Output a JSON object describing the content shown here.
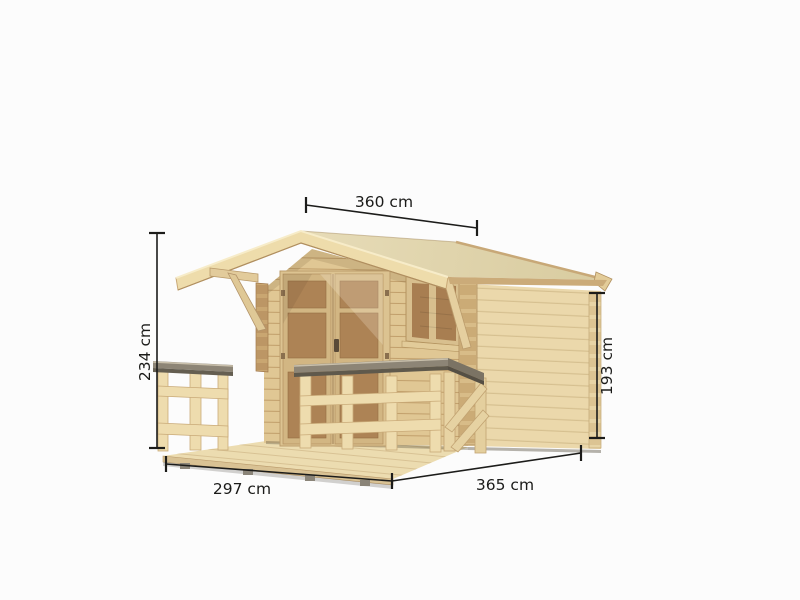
{
  "scene": {
    "subject": "Wooden garden log cabin with gable roof, front porch, terrace and wooden railing",
    "style": "Product dimension diagram on white background",
    "background_color": "#fcfcfc"
  },
  "dimensions": {
    "roof_width": {
      "label": "360 cm",
      "value_cm": 360,
      "placement": "top, along roof ridge"
    },
    "total_height": {
      "label": "234 cm",
      "value_cm": 234,
      "placement": "left, ground to ridge"
    },
    "wall_height": {
      "label": "193 cm",
      "value_cm": 193,
      "placement": "right, ground to eave"
    },
    "terrace_depth": {
      "label": "297 cm",
      "value_cm": 297,
      "placement": "bottom left, terrace front edge"
    },
    "building_width": {
      "label": "365 cm",
      "value_cm": 365,
      "placement": "bottom right, side wall"
    }
  },
  "colors": {
    "dimension_line": "#1c1c1a",
    "roof_top": "#e0d5ae",
    "bargeboard": "#eedcab",
    "front_wall": "#e0c794",
    "side_wall": "#ebd8ab",
    "door_panel": "#ad8355",
    "window_pane": "#a87e51",
    "railing_wood": "#eedcae",
    "railing_cap_gray": "#8d8576",
    "terrace_floor": "#ecdcb0"
  }
}
